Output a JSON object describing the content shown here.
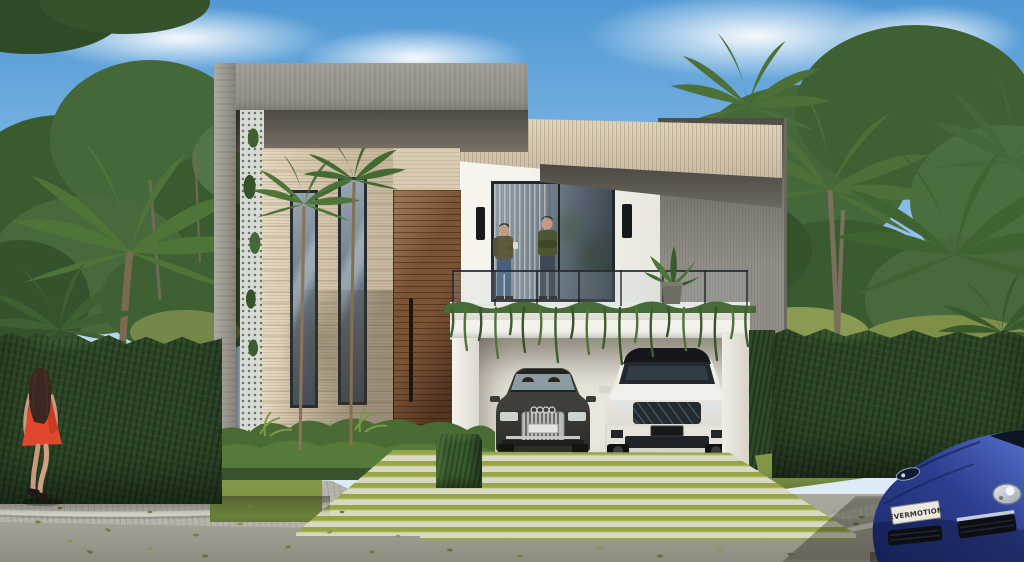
{
  "scene": {
    "type": "exterior architectural 3D rendering",
    "time": "sunny daytime",
    "setting": "tropical residential street",
    "description": "Modern two-storey villa in white render, grey concrete and travertine, with a slatted wood pivot door, plant-draped balcony, open double carport with two parked cars, striped grass driveway, tall trimmed hedges and palm trees; a woman in a red dress walks past and a blue sports car sits at the kerb"
  },
  "house": {
    "label": "modern villa",
    "features": [
      "grey concrete frame",
      "travertine stone facade",
      "two tall slot windows",
      "green trellis wall",
      "slatted wood pivot door",
      "second-floor glass sliding door",
      "balcony with glass railing and trailing plants",
      "travertine roof canopy",
      "open double carport"
    ]
  },
  "people": {
    "balcony_left": "man holding a mug",
    "balcony_right": "man with crossed arms",
    "street": "woman in red dress walking on the cobbled sidewalk"
  },
  "vehicles": {
    "sedan": {
      "label": "dark grey sedan",
      "location": "carport left bay"
    },
    "suv": {
      "label": "white luxury SUV",
      "location": "carport right bay"
    },
    "sports_car": {
      "label": "blue sports car",
      "location": "street, bottom right corner",
      "plate": "EVERMOTION"
    }
  },
  "vegetation": [
    "coconut palms",
    "tropical broadleaf trees",
    "trimmed box hedges",
    "ground-cover shrubs",
    "hanging balcony vines",
    "striped grass and concrete driveway"
  ],
  "colors": {
    "sky_top": "#4f98d4",
    "sky_mid": "#8abde8",
    "sky_horizon": "#d3e6f4",
    "tree_dark": "#35522c",
    "tree_mid": "#45683a",
    "tree_light": "#5d8145",
    "bush_yellow": "#86984e",
    "palm": "#4e7438",
    "palm_dark": "#3a5a2b",
    "trunk": "#7b6a52",
    "concrete": "#908e86",
    "concrete_dark": "#55534c",
    "travertine": "#d9cbb1",
    "white_wall": "#f3f1ea",
    "wood": "#7b5335",
    "glass": "#6b7a86",
    "hedge": "#2c4526",
    "lawn": "#7f9346",
    "stripe_green": "#97a447",
    "stripe_pale": "#dbd7c5",
    "cobble": "#b4b1a7",
    "road": "#a29d92",
    "sedan": "#3b3b38",
    "suv": "#ecebe4",
    "sports_blue": "#2c3e8f",
    "dress": "#e0472f",
    "skin": "#c79a80",
    "plate": "#eceae2",
    "trim_black": "#17191c"
  }
}
